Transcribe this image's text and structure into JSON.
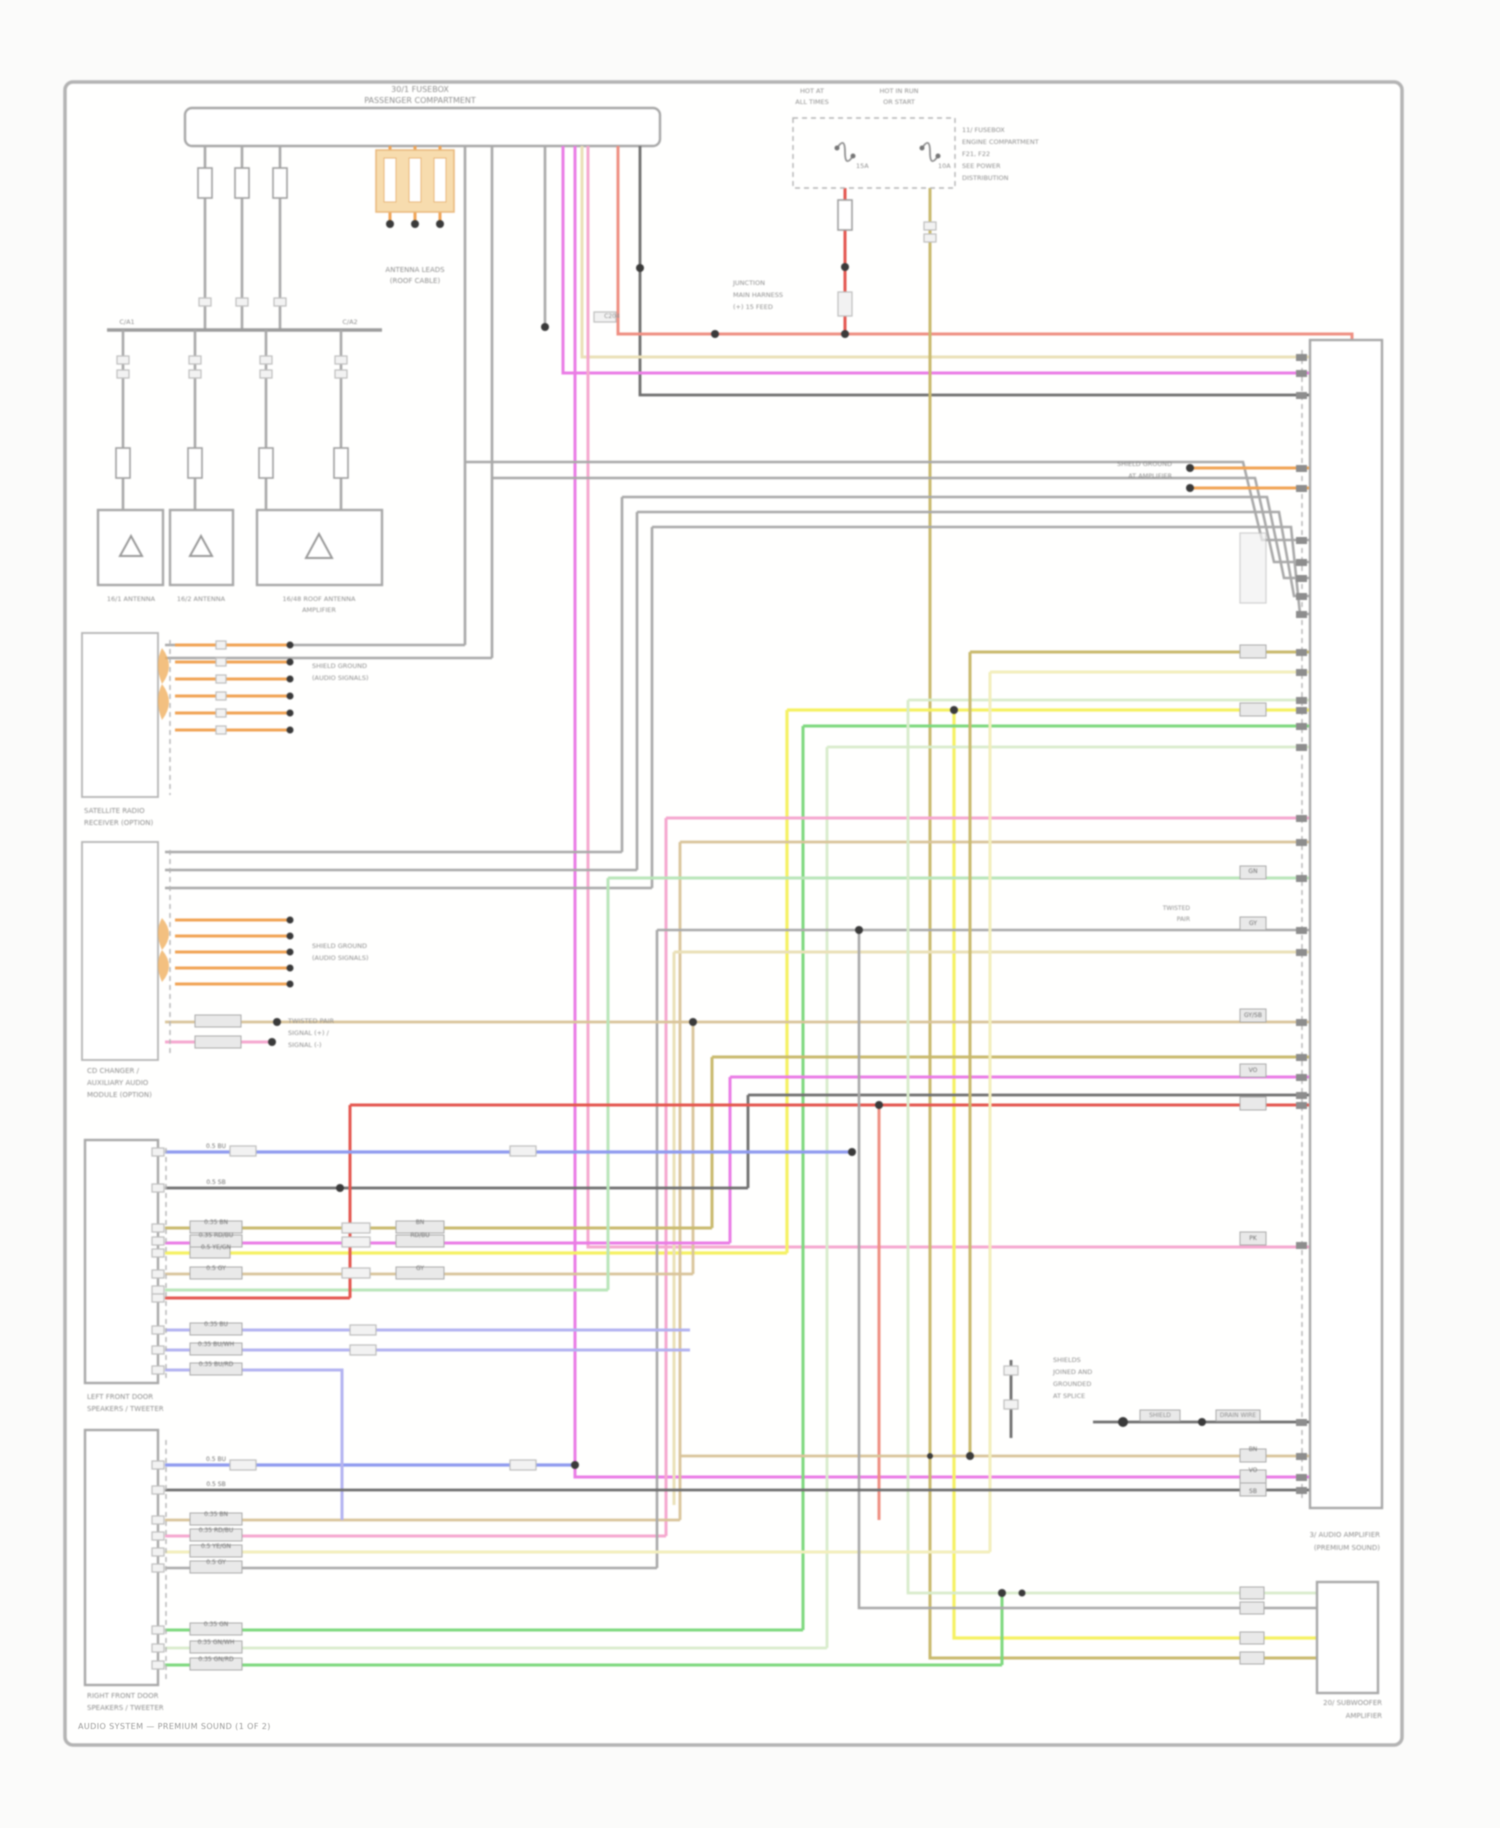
{
  "title": "Audio System Wiring Diagram",
  "footer": {
    "text": "AUDIO SYSTEM — PREMIUM SOUND (1 OF 2)"
  },
  "colors": {
    "page_border": "#b3b3b3",
    "wire_gray": "#a9a9a9",
    "wire_dark": "#6f6f6f",
    "wire_orange": "#f0a355",
    "wire_magenta": "#ea7ce5",
    "wire_pink": "#f6a8cf",
    "wire_red": "#e4574f",
    "wire_salmon": "#ef8f83",
    "wire_khaki": "#c9ba6e",
    "wire_yellow": "#f5f163",
    "wire_green": "#7ed87e",
    "wire_blue": "#8f9bef",
    "wire_violet": "#b3b3f0",
    "wire_tan": "#d9c49a",
    "terminal_dot": "#3a3a3a"
  },
  "labels": [
    {
      "t": "30/1 FUSEBOX",
      "x": 420,
      "y": 92,
      "a": "middle",
      "s": 8
    },
    {
      "t": "PASSENGER COMPARTMENT",
      "x": 420,
      "y": 103,
      "a": "middle",
      "s": 8
    },
    {
      "t": "ANTENNA LEADS",
      "x": 415,
      "y": 272,
      "a": "middle",
      "s": 7
    },
    {
      "t": "(ROOF CABLE)",
      "x": 415,
      "y": 283,
      "a": "middle",
      "s": 7
    },
    {
      "t": "C/A1",
      "x": 127,
      "y": 324,
      "a": "middle",
      "s": 6.5
    },
    {
      "t": "C/A2",
      "x": 350,
      "y": 324,
      "a": "middle",
      "s": 6.5
    },
    {
      "t": "16/1 ANTENNA",
      "x": 131,
      "y": 601,
      "a": "middle",
      "s": 6.5
    },
    {
      "t": "16/2 ANTENNA",
      "x": 201,
      "y": 601,
      "a": "middle",
      "s": 6.5
    },
    {
      "t": "16/48 ROOF ANTENNA",
      "x": 319,
      "y": 601,
      "a": "middle",
      "s": 6.5
    },
    {
      "t": "AMPLIFIER",
      "x": 319,
      "y": 612,
      "a": "middle",
      "s": 6.5
    },
    {
      "t": "SATELLITE RADIO",
      "x": 84,
      "y": 813,
      "a": "start",
      "s": 7
    },
    {
      "t": "RECEIVER (OPTION)",
      "x": 84,
      "y": 825,
      "a": "start",
      "s": 7
    },
    {
      "t": "SHIELD GROUND",
      "x": 312,
      "y": 668,
      "a": "start",
      "s": 6.5
    },
    {
      "t": "(AUDIO SIGNALS)",
      "x": 312,
      "y": 680,
      "a": "start",
      "s": 6.5
    },
    {
      "t": "CD CHANGER /",
      "x": 87,
      "y": 1073,
      "a": "start",
      "s": 7
    },
    {
      "t": "AUXILIARY AUDIO",
      "x": 87,
      "y": 1085,
      "a": "start",
      "s": 7
    },
    {
      "t": "MODULE (OPTION)",
      "x": 87,
      "y": 1097,
      "a": "start",
      "s": 7
    },
    {
      "t": "SHIELD GROUND",
      "x": 312,
      "y": 948,
      "a": "start",
      "s": 6.5
    },
    {
      "t": "(AUDIO SIGNALS)",
      "x": 312,
      "y": 960,
      "a": "start",
      "s": 6.5
    },
    {
      "t": "TWISTED PAIR",
      "x": 288,
      "y": 1023,
      "a": "start",
      "s": 6.5
    },
    {
      "t": "SIGNAL (+) /",
      "x": 288,
      "y": 1035,
      "a": "start",
      "s": 6.5
    },
    {
      "t": "SIGNAL (-)",
      "x": 288,
      "y": 1047,
      "a": "start",
      "s": 6.5
    },
    {
      "t": "JUNCTION",
      "x": 733,
      "y": 285,
      "a": "start",
      "s": 6.5
    },
    {
      "t": "MAIN HARNESS",
      "x": 733,
      "y": 297,
      "a": "start",
      "s": 6.5
    },
    {
      "t": "(+) 15 FEED",
      "x": 733,
      "y": 309,
      "a": "start",
      "s": 6.5
    },
    {
      "t": "C204",
      "x": 612,
      "y": 318,
      "a": "middle",
      "s": 6
    },
    {
      "t": "HOT AT",
      "x": 812,
      "y": 93,
      "a": "middle",
      "s": 6.5
    },
    {
      "t": "ALL TIMES",
      "x": 812,
      "y": 104,
      "a": "middle",
      "s": 6.5
    },
    {
      "t": "HOT IN RUN",
      "x": 899,
      "y": 93,
      "a": "middle",
      "s": 6.5
    },
    {
      "t": "OR START",
      "x": 899,
      "y": 104,
      "a": "middle",
      "s": 6.5
    },
    {
      "t": "15A",
      "x": 856,
      "y": 168,
      "a": "start",
      "s": 6.5
    },
    {
      "t": "10A",
      "x": 938,
      "y": 168,
      "a": "start",
      "s": 6.5
    },
    {
      "t": "11/ FUSEBOX",
      "x": 962,
      "y": 132,
      "a": "start",
      "s": 6.5
    },
    {
      "t": "ENGINE COMPARTMENT",
      "x": 962,
      "y": 144,
      "a": "start",
      "s": 6.5
    },
    {
      "t": "F21, F22",
      "x": 962,
      "y": 156,
      "a": "start",
      "s": 6.5
    },
    {
      "t": "SEE POWER",
      "x": 962,
      "y": 168,
      "a": "start",
      "s": 6.5
    },
    {
      "t": "DISTRIBUTION",
      "x": 962,
      "y": 180,
      "a": "start",
      "s": 6.5
    },
    {
      "t": "SHIELD GROUND",
      "x": 1172,
      "y": 466,
      "a": "end",
      "s": 6.5
    },
    {
      "t": "AT AMPLIFIER",
      "x": 1172,
      "y": 478,
      "a": "end",
      "s": 6.5
    },
    {
      "t": "SHIELDS",
      "x": 1053,
      "y": 1362,
      "a": "start",
      "s": 6.5
    },
    {
      "t": "JOINED AND",
      "x": 1053,
      "y": 1374,
      "a": "start",
      "s": 6.5
    },
    {
      "t": "GROUNDED",
      "x": 1053,
      "y": 1386,
      "a": "start",
      "s": 6.5
    },
    {
      "t": "AT SPLICE",
      "x": 1053,
      "y": 1398,
      "a": "start",
      "s": 6.5
    },
    {
      "t": "SHIELD",
      "x": 1160,
      "y": 1417,
      "a": "middle",
      "s": 6
    },
    {
      "t": "DRAIN WIRE",
      "x": 1238,
      "y": 1417,
      "a": "middle",
      "s": 6
    },
    {
      "t": "TWISTED",
      "x": 1190,
      "y": 910,
      "a": "end",
      "s": 6
    },
    {
      "t": "PAIR",
      "x": 1190,
      "y": 921,
      "a": "end",
      "s": 6
    },
    {
      "t": "3/ AUDIO AMPLIFIER",
      "x": 1380,
      "y": 1537,
      "a": "end",
      "s": 7
    },
    {
      "t": "(PREMIUM SOUND)",
      "x": 1380,
      "y": 1550,
      "a": "end",
      "s": 7
    },
    {
      "t": "20/ SUBWOOFER",
      "x": 1382,
      "y": 1705,
      "a": "end",
      "s": 7
    },
    {
      "t": "AMPLIFIER",
      "x": 1382,
      "y": 1718,
      "a": "end",
      "s": 7
    },
    {
      "t": "LEFT FRONT DOOR",
      "x": 87,
      "y": 1399,
      "a": "start",
      "s": 7
    },
    {
      "t": "SPEAKERS / TWEETER",
      "x": 87,
      "y": 1411,
      "a": "start",
      "s": 7
    },
    {
      "t": "RIGHT FRONT DOOR",
      "x": 87,
      "y": 1698,
      "a": "start",
      "s": 7
    },
    {
      "t": "SPEAKERS / TWEETER",
      "x": 87,
      "y": 1710,
      "a": "start",
      "s": 7
    },
    {
      "t": "0.35 BN",
      "x": 216,
      "y": 1224,
      "a": "middle",
      "s": 6,
      "c": "smudge"
    },
    {
      "t": "0.35 RD/BU",
      "x": 216,
      "y": 1237,
      "a": "middle",
      "s": 6,
      "c": "smudge"
    },
    {
      "t": "0.5 YE/GN",
      "x": 216,
      "y": 1249,
      "a": "middle",
      "s": 6,
      "c": "smudge"
    },
    {
      "t": "0.5 GY",
      "x": 216,
      "y": 1270,
      "a": "middle",
      "s": 6,
      "c": "smudge"
    },
    {
      "t": "0.5 BU",
      "x": 216,
      "y": 1148,
      "a": "middle",
      "s": 6,
      "c": "smudge"
    },
    {
      "t": "0.5 SB",
      "x": 216,
      "y": 1184,
      "a": "middle",
      "s": 6,
      "c": "smudge"
    },
    {
      "t": "BN",
      "x": 420,
      "y": 1224,
      "a": "middle",
      "s": 6,
      "c": "smudge"
    },
    {
      "t": "RD/BU",
      "x": 420,
      "y": 1237,
      "a": "middle",
      "s": 6,
      "c": "smudge"
    },
    {
      "t": "GY",
      "x": 420,
      "y": 1270,
      "a": "middle",
      "s": 6,
      "c": "smudge"
    },
    {
      "t": "0.35 BU",
      "x": 216,
      "y": 1326,
      "a": "middle",
      "s": 6,
      "c": "smudge"
    },
    {
      "t": "0.35 BU/WH",
      "x": 216,
      "y": 1346,
      "a": "middle",
      "s": 6,
      "c": "smudge"
    },
    {
      "t": "0.35 BU/RD",
      "x": 216,
      "y": 1366,
      "a": "middle",
      "s": 6,
      "c": "smudge"
    },
    {
      "t": "0.5 BU",
      "x": 216,
      "y": 1461,
      "a": "middle",
      "s": 6,
      "c": "smudge"
    },
    {
      "t": "0.5 SB",
      "x": 216,
      "y": 1486,
      "a": "middle",
      "s": 6,
      "c": "smudge"
    },
    {
      "t": "0.35 BN",
      "x": 216,
      "y": 1516,
      "a": "middle",
      "s": 6,
      "c": "smudge"
    },
    {
      "t": "0.35 RD/BU",
      "x": 216,
      "y": 1532,
      "a": "middle",
      "s": 6,
      "c": "smudge"
    },
    {
      "t": "0.5 YE/GN",
      "x": 216,
      "y": 1548,
      "a": "middle",
      "s": 6,
      "c": "smudge"
    },
    {
      "t": "0.5 GY",
      "x": 216,
      "y": 1564,
      "a": "middle",
      "s": 6,
      "c": "smudge"
    },
    {
      "t": "0.35 GN",
      "x": 216,
      "y": 1626,
      "a": "middle",
      "s": 6,
      "c": "smudge"
    },
    {
      "t": "0.35 GN/WH",
      "x": 216,
      "y": 1644,
      "a": "middle",
      "s": 6,
      "c": "smudge"
    },
    {
      "t": "0.35 GN/RD",
      "x": 216,
      "y": 1661,
      "a": "middle",
      "s": 6,
      "c": "smudge"
    },
    {
      "t": "GN",
      "x": 1253,
      "y": 873,
      "a": "middle",
      "s": 6,
      "c": "smudge"
    },
    {
      "t": "GY",
      "x": 1253,
      "y": 925,
      "a": "middle",
      "s": 6,
      "c": "smudge"
    },
    {
      "t": "GY/SB",
      "x": 1253,
      "y": 1017,
      "a": "middle",
      "s": 6,
      "c": "smudge"
    },
    {
      "t": "VO",
      "x": 1253,
      "y": 1072,
      "a": "middle",
      "s": 6,
      "c": "smudge"
    },
    {
      "t": "PK",
      "x": 1253,
      "y": 1240,
      "a": "middle",
      "s": 6,
      "c": "smudge"
    },
    {
      "t": "BN",
      "x": 1253,
      "y": 1451,
      "a": "middle",
      "s": 6,
      "c": "smudge"
    },
    {
      "t": "VO",
      "x": 1253,
      "y": 1472,
      "a": "middle",
      "s": 6,
      "c": "smudge"
    },
    {
      "t": "SB",
      "x": 1253,
      "y": 1493,
      "a": "middle",
      "s": 6,
      "c": "smudge"
    }
  ]
}
